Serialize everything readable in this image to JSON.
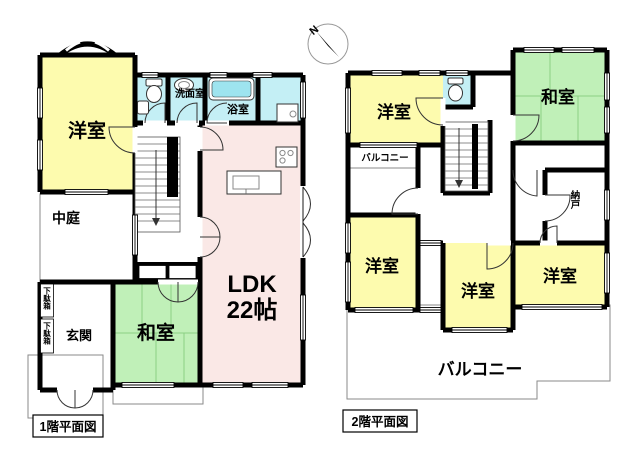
{
  "document_title": "間取り図",
  "compass": {
    "north_label": "N"
  },
  "colors": {
    "room_yellow": "#fdfbae",
    "room_green": "#c0f0b8",
    "room_pink": "#fae8e6",
    "room_cyan": "#c4eff5",
    "tub_fill": "#9ee4ef",
    "wall": "#000000",
    "background": "#ffffff"
  },
  "floor1": {
    "caption": "1階平面図",
    "western_room": "洋室",
    "courtyard": "中庭",
    "entrance": "玄関",
    "shoe_box": "下駄箱",
    "washroom": "洗面室",
    "bathroom": "浴室",
    "japanese_room": "和室",
    "ldk_name": "LDK",
    "ldk_size": "22帖"
  },
  "floor2": {
    "caption": "2階平面図",
    "western_room_nw": "洋室",
    "western_room_sw": "洋室",
    "western_room_s": "洋室",
    "western_room_se": "洋室",
    "japanese_room": "和室",
    "storage": "納戸",
    "balcony_small": "バルコニー",
    "balcony_large": "バルコニー"
  }
}
